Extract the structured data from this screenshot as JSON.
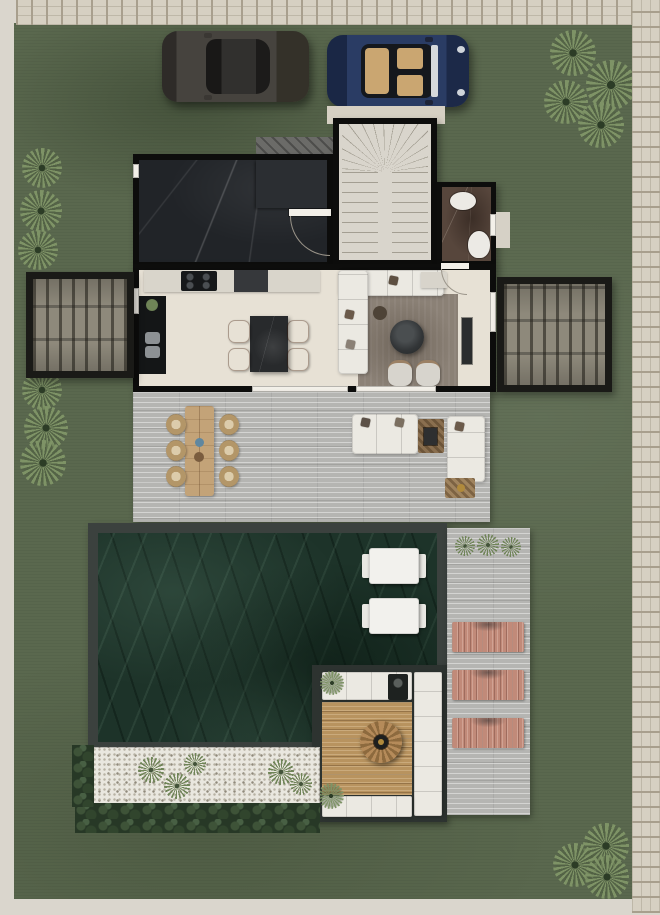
{
  "scene": {
    "name": "villa-ground-floor-site-plan",
    "areas": [
      "driveway-lawn",
      "dark-marble-room",
      "staircase",
      "bathroom",
      "kitchen",
      "living-room",
      "louvered-pergola-left",
      "louvered-pergola-right",
      "outdoor-deck",
      "outdoor-dining",
      "outdoor-lounge",
      "green-marble-pool",
      "sunken-fire-lounge",
      "sun-deck",
      "pebble-garden",
      "shrub-border"
    ],
    "inventory": {
      "cars": 2,
      "kitchen_island_chairs": 4,
      "outdoor_dining_chairs": 6,
      "living_armchairs": 2,
      "pool_daybeds": 2,
      "pink_sun_loungers": 3,
      "agave_plant_clusters": 4,
      "agave_plants_total": 13,
      "pebble_grass_tufts": 5,
      "sun_deck_grass_tufts": 3,
      "bathroom_fixtures": 2
    },
    "palette": {
      "outer": "#dad6cd",
      "stone": "#d6d0c2",
      "stone_joint": "#a89f8d",
      "lawn": "#5a684e",
      "wall": "#0d0d0c",
      "floor_cream": "#e7e1d5",
      "counter": "#d9d5cb",
      "marble_black": "#212428",
      "marble_brown": "#57463c",
      "stair_floor": "#d9d5cc",
      "tread_line": "#a39e92",
      "deck": "#b5b5b2",
      "pergola_slat": "#8e897b",
      "pergola_frame": "#1a1a17",
      "island": "#282a2c",
      "terracotta": "#c26a43",
      "rug": "#8b8176",
      "sofa": "#ebe9e2",
      "coffee_table": "#323537",
      "pool_frame": "#3b413e",
      "pool_marble": "#1d3329",
      "wood": "#c3a378",
      "lounger_pink": "#c18a79",
      "pebble": "#e9e7df",
      "shrub": "#273826",
      "plant": "#7e9366",
      "plant_dark": "#2c3c26",
      "car_dark": "#46433e",
      "car_blue": "#2a3c64",
      "car_interior_tan": "#caa671",
      "fixture_white": "#eceae5"
    }
  }
}
